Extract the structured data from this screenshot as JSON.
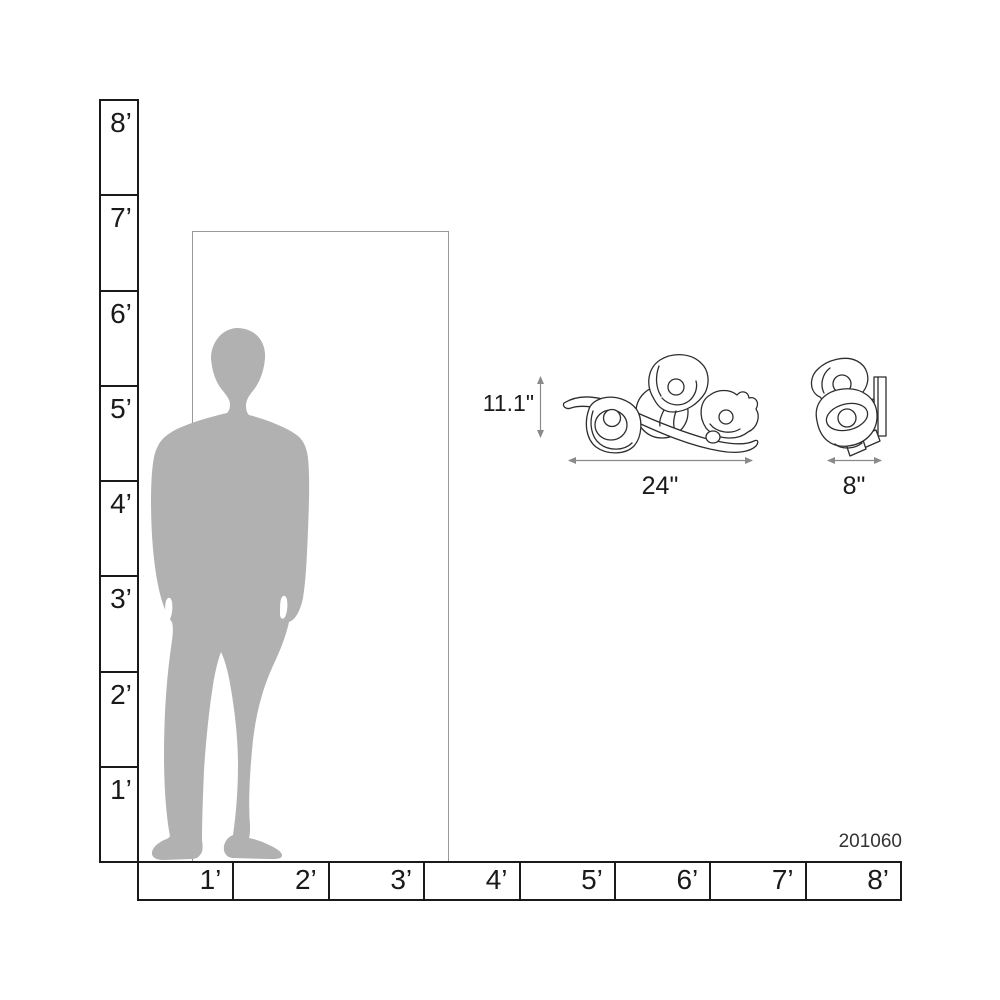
{
  "product": {
    "id": "201060"
  },
  "scale_rulers": {
    "vertical_labels_top_to_bottom": [
      "8’",
      "7’",
      "6’",
      "5’",
      "4’",
      "3’",
      "2’",
      "1’"
    ],
    "horizontal_labels_left_to_right": [
      "1’",
      "2’",
      "3’",
      "4’",
      "5’",
      "6’",
      "7’",
      "8’"
    ]
  },
  "dimensions": {
    "height_label": "11.1\"",
    "width_label": "24\"",
    "depth_label": "8\""
  },
  "drawings": {
    "person": "standing-man-silhouette",
    "door": "door-frame-outline",
    "front_view": "wall-sconce-front-view",
    "side_view": "wall-sconce-side-view"
  },
  "colors": {
    "background": "#ffffff",
    "ruler_line": "#1a1a1a",
    "label_text": "#1a1a1a",
    "door_frame_line": "#9a9a9a",
    "silhouette_fill": "#b1b1b1",
    "fixture_line": "#2e2e2e",
    "dimension_line": "#8a8a8a",
    "product_id_text": "#333333"
  }
}
